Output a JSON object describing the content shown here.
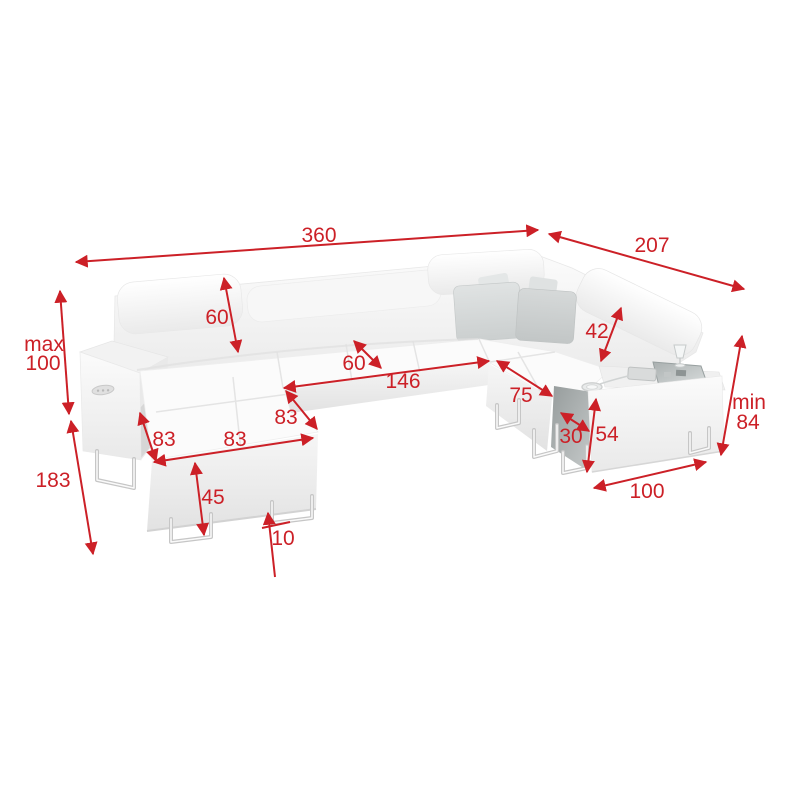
{
  "page": {
    "background": "#ffffff"
  },
  "diagram": {
    "product": "u-shaped-corner-sofa-with-bar-armrest",
    "accent_color": "#cc2027",
    "pillow_color": "#d3d6d6",
    "units": "",
    "dimensions": {
      "total_width": "360",
      "total_depth_right": "207",
      "height_max_prefix": "max",
      "height_max_value": "100",
      "chaise_total_depth": "183",
      "backrest_height": "60",
      "seat_depth": "60",
      "seat_front_width": "146",
      "chaise_side_depth": "83",
      "chaise_front_width": "83",
      "chaise_left_width": "83",
      "base_front_height": "45",
      "leg_height": "10",
      "corner_seat_width": "75",
      "headrest_height": "42",
      "armrest_top_width": "30",
      "armrest_height": "54",
      "right_module_width": "100",
      "height_min_prefix": "min",
      "height_min_value": "84"
    }
  }
}
